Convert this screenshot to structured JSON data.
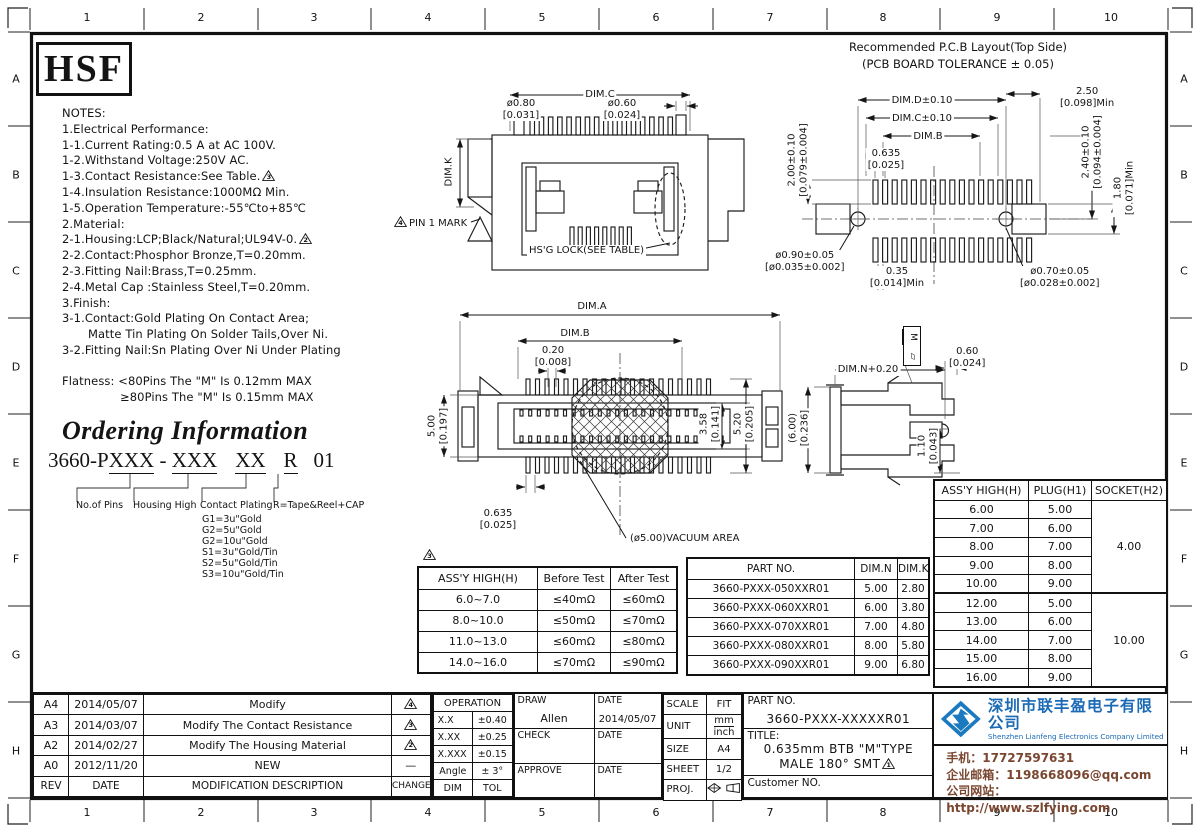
{
  "frame": {
    "cols": [
      "1",
      "2",
      "3",
      "4",
      "5",
      "6",
      "7",
      "8",
      "9",
      "10"
    ],
    "rows": [
      "A",
      "B",
      "C",
      "D",
      "E",
      "F",
      "G",
      "H"
    ]
  },
  "brand": {
    "logo": "HSF"
  },
  "markers": {
    "m1": "1",
    "m2": "2",
    "m3": "3",
    "m4": "4"
  },
  "notes": {
    "lines": [
      "NOTES:",
      "1.Electrical Performance:",
      "1-1.Current Rating:0.5 A at AC 100V.",
      "1-2.Withstand Voltage:250V AC.",
      "1-3.Contact Resistance:See Table.",
      "1-4.Insulation Resistance:1000MΩ Min.",
      "1-5.Operation Temperature:-55℃to+85℃",
      "2.Material:",
      "2-1.Housing:LCP;Black/Natural;UL94V-0.",
      "2-2.Contact:Phosphor Bronze,T=0.20mm.",
      "2-3.Fitting Nail:Brass,T=0.25mm.",
      "2-4.Metal Cap :Stainless Steel,T=0.20mm.",
      "3.Finish:",
      "3-1.Contact:Gold Plating On Contact Area;",
      "Matte Tin Plating On Solder Tails,Over Ni.",
      "3-2.Fitting Nail:Sn Plating Over Ni Under Plating"
    ],
    "flatness_1": "Flatness: <80Pins The \"M\" Is 0.12mm MAX",
    "flatness_2": "≥80Pins The \"M\" Is 0.15mm MAX"
  },
  "ordering": {
    "title": "Ordering Information",
    "pn_prefix": "3660-P",
    "pn_x1": "XXX",
    "pn_dash": " - ",
    "pn_x2": "XXX",
    "pn_x3": "XX",
    "pn_r": "R",
    "pn_end": "01",
    "labels": [
      "No.of Pins",
      "Housing High",
      "Contact Plating",
      "R=Tape&Reel+CAP"
    ],
    "options": [
      "G1=3u\"Gold",
      "G2=5u\"Gold",
      "G2=10u\"Gold",
      "S1=3u\"Gold/Tin",
      "S2=5u\"Gold/Tin",
      "S3=10u\"Gold/Tin"
    ]
  },
  "drawings": {
    "top_view": {
      "dim_c": "DIM.C",
      "dia_left_1": "ø0.80",
      "dia_left_2": "[0.031]",
      "dia_right_1": "ø0.60",
      "dia_right_2": "[0.024]",
      "dim_k": "DIM.K",
      "pin1_label": "PIN 1 MARK",
      "hsg_lock": "HS'G LOCK(SEE TABLE)"
    },
    "bottom_view": {
      "dim_a": "DIM.A",
      "dim_b": "DIM.B",
      "p020_1": "0.20",
      "p020_2": "[0.008]",
      "h500_1": "5.00",
      "h500_2": "[0.197]",
      "h358_1": "3.58",
      "h358_2": "[0.141]",
      "h520_1": "5.20",
      "h520_2": "[0.205]",
      "p0635_1": "0.635",
      "p0635_2": "[0.025]",
      "vacuum": "(ø5.00)VACUUM AREA"
    },
    "pcb": {
      "title1": "Recommended P.C.B Layout(Top Side)",
      "title2": "(PCB BOARD TOLERANCE ± 0.05)",
      "dim_d": "DIM.D±0.10",
      "dim_c": "DIM.C±0.10",
      "dim_b": "DIM.B",
      "p0635_1": "0.635",
      "p0635_2": "[0.025]",
      "left_1": "2.00±0.10",
      "left_2": "[0.079±0.004]",
      "r250_1": "2.50",
      "r250_2": "[0.098]Min",
      "r240_1": "2.40±0.10",
      "r240_2": "[0.094±0.004]",
      "r180_1": "1.80",
      "r180_2": "[0.071]Min",
      "d090_1": "ø0.90±0.05",
      "d090_2": "[ø0.035±0.002]",
      "p035_1": "0.35",
      "p035_2": "[0.014]Min",
      "d070_1": "ø0.70±0.05",
      "d070_2": "[ø0.028±0.002]"
    },
    "side_view": {
      "dim_n": "DIM.N+0.20",
      "p060_1": "0.60",
      "p060_2": "[0.024]",
      "h600_1": "(6.00)",
      "h600_2": "[0.236]",
      "h110_1": "1.10",
      "h110_2": "[0.043]",
      "flat_m": "M",
      "flat_sym": "▱"
    }
  },
  "tables": {
    "resistance": {
      "headers": [
        "ASS'Y HIGH(H)",
        "Before Test",
        "After Test"
      ],
      "rows": [
        [
          "6.0~7.0",
          "≤40mΩ",
          "≤60mΩ"
        ],
        [
          "8.0~10.0",
          "≤50mΩ",
          "≤70mΩ"
        ],
        [
          "11.0~13.0",
          "≤60mΩ",
          "≤80mΩ"
        ],
        [
          "14.0~16.0",
          "≤70mΩ",
          "≤90mΩ"
        ]
      ]
    },
    "partno": {
      "headers": [
        "PART NO.",
        "DIM.N",
        "DIM.K"
      ],
      "rows": [
        [
          "3660-PXXX-050XXR01",
          "5.00",
          "2.80"
        ],
        [
          "3660-PXXX-060XXR01",
          "6.00",
          "3.80"
        ],
        [
          "3660-PXXX-070XXR01",
          "7.00",
          "4.80"
        ],
        [
          "3660-PXXX-080XXR01",
          "8.00",
          "5.80"
        ],
        [
          "3660-PXXX-090XXR01",
          "9.00",
          "6.80"
        ]
      ]
    },
    "height": {
      "headers": [
        "ASS'Y HIGH(H)",
        "PLUG(H1)",
        "SOCKET(H2)"
      ],
      "g1": [
        [
          "6.00",
          "5.00"
        ],
        [
          "7.00",
          "6.00"
        ],
        [
          "8.00",
          "7.00"
        ],
        [
          "9.00",
          "8.00"
        ],
        [
          "10.00",
          "9.00"
        ]
      ],
      "socket1": "4.00",
      "g2": [
        [
          "12.00",
          "5.00"
        ],
        [
          "13.00",
          "6.00"
        ],
        [
          "14.00",
          "7.00"
        ],
        [
          "15.00",
          "8.00"
        ],
        [
          "16.00",
          "9.00"
        ]
      ],
      "socket2": "10.00"
    }
  },
  "revision": {
    "headers": {
      "rev": "REV",
      "date": "DATE",
      "desc": "MODIFICATION DESCRIPTION",
      "change": "CHANGE"
    },
    "rows": [
      {
        "rev": "A4",
        "date": "2014/05/07",
        "desc": "Modify",
        "change": "4"
      },
      {
        "rev": "A3",
        "date": "2014/03/07",
        "desc": "Modify The Contact Resistance",
        "change": "3"
      },
      {
        "rev": "A2",
        "date": "2014/02/27",
        "desc": "Modify The Housing Material",
        "change": "2"
      },
      {
        "rev": "A0",
        "date": "2012/11/20",
        "desc": "NEW",
        "change": "—"
      }
    ]
  },
  "operation": {
    "title": "OPERATION",
    "rows": [
      [
        "X.X",
        "±0.40"
      ],
      [
        "X.XX",
        "±0.25"
      ],
      [
        "X.XXX",
        "±0.15"
      ],
      [
        "Angle",
        "± 3°"
      ],
      [
        "DIM",
        "TOL"
      ]
    ]
  },
  "approval": {
    "draw": "DRAW",
    "date": "DATE",
    "name": "Allen",
    "draw_date": "2014/05/07",
    "check": "CHECK",
    "approve": "APPROVE"
  },
  "info": {
    "scale": "SCALE",
    "scale_v": "FIT",
    "unit": "UNIT",
    "unit_mm": "mm",
    "unit_inch": "inch",
    "size": "SIZE",
    "size_v": "A4",
    "sheet": "SHEET",
    "sheet_v": "1/2",
    "proj": "PROJ."
  },
  "titleblock": {
    "partno_label": "PART NO.",
    "partno": "3660-PXXX-XXXXXR01",
    "title_label": "TITLE:",
    "title_line1": "0.635mm BTB \"M\"TYPE",
    "title_line2": "MALE 180° SMT",
    "customer_label": "Customer NO."
  },
  "company": {
    "name_cn": "深圳市联丰盈电子有限公司",
    "name_en": "Shenzhen Lianfeng Electronics Company Limited",
    "phone": "手机：17727597631",
    "email": "企业邮箱：1198668096@qq.com",
    "website": "公司网站：http://www.szlfying.com"
  }
}
